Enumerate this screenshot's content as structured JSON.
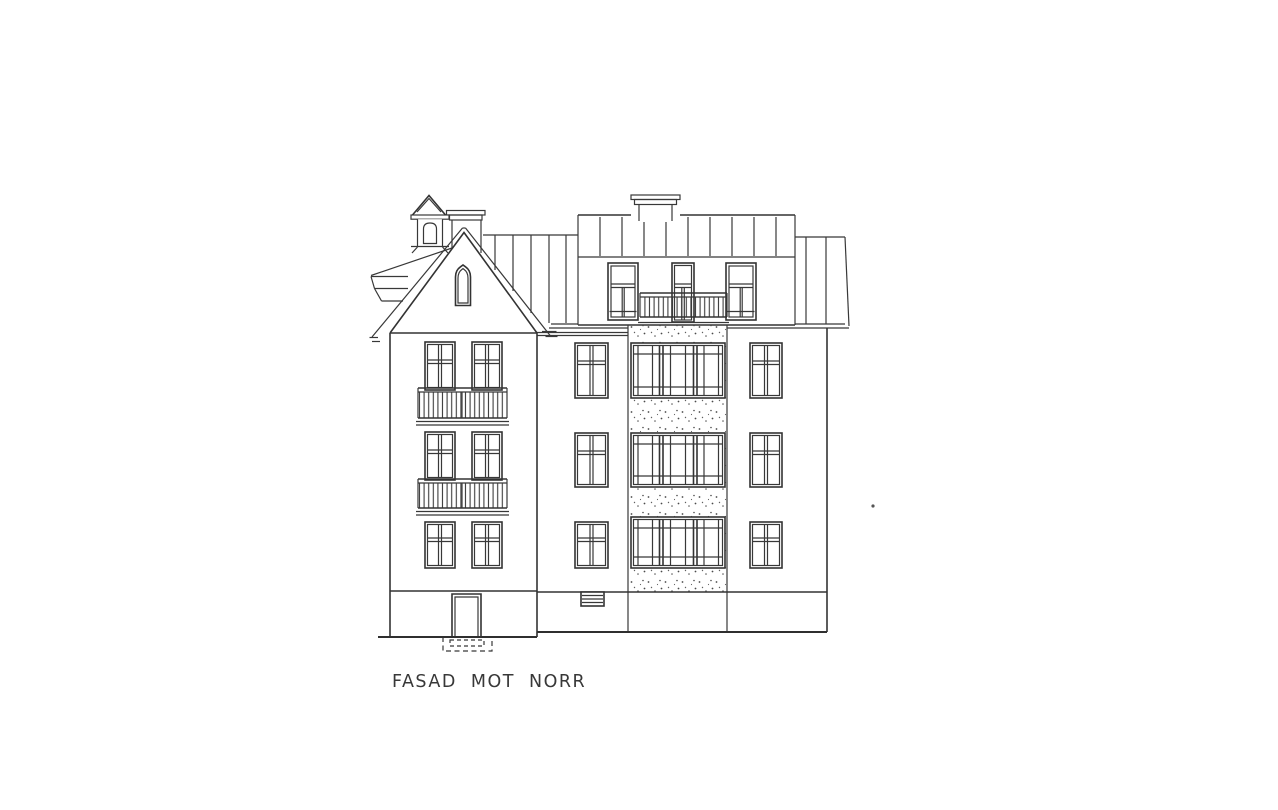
{
  "page": {
    "background": "#ffffff"
  },
  "drawing": {
    "caption": "FASAD MOT NORR",
    "ink_color": "#383838",
    "paper_color": "#ffffff"
  }
}
